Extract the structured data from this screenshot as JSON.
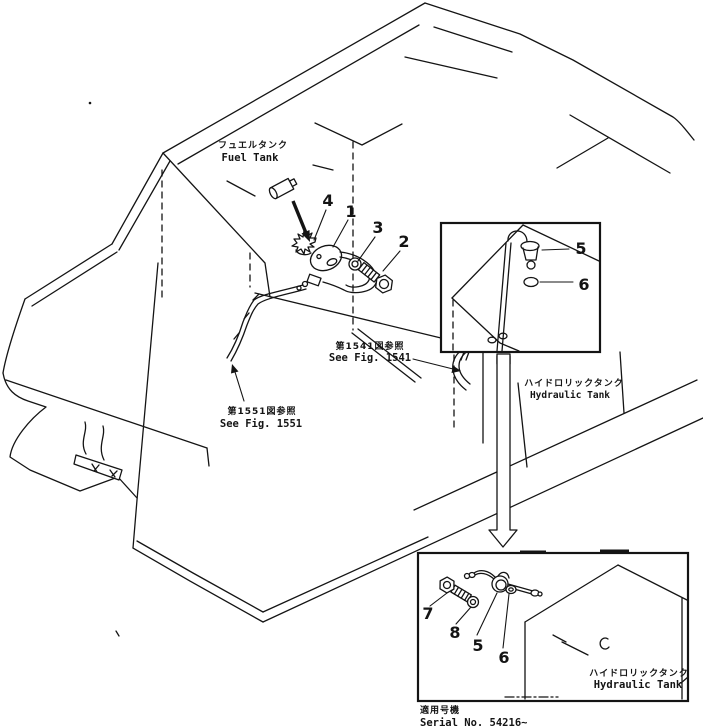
{
  "figure": {
    "fuel_tank_label": {
      "jp": "フュエルタンク",
      "en": "Fuel  Tank"
    },
    "hydraulic_tank_label_main": {
      "jp": "ハイドロリックタンク",
      "en": "Hydraulic  Tank"
    },
    "hydraulic_tank_label_inset": {
      "jp": "ハイドロリックタンク",
      "en": "Hydraulic  Tank"
    },
    "see_fig_1541": {
      "jp": "第1541図参照",
      "en": "See  Fig. 1541"
    },
    "see_fig_1551": {
      "jp": "第1551図参照",
      "en": "See  Fig. 1551"
    },
    "serial_note": {
      "jp": "適用号機",
      "en": "Serial  No. 54216~"
    },
    "callouts_main": {
      "n4": "4",
      "n1": "1",
      "n3": "3",
      "n2": "2"
    },
    "callouts_inset_top": {
      "n5": "5",
      "n6": "6"
    },
    "callouts_inset_bottom": {
      "n7": "7",
      "n8": "8",
      "n5": "5",
      "n6": "6"
    },
    "colors": {
      "line": "#141414",
      "background": "#ffffff"
    }
  }
}
